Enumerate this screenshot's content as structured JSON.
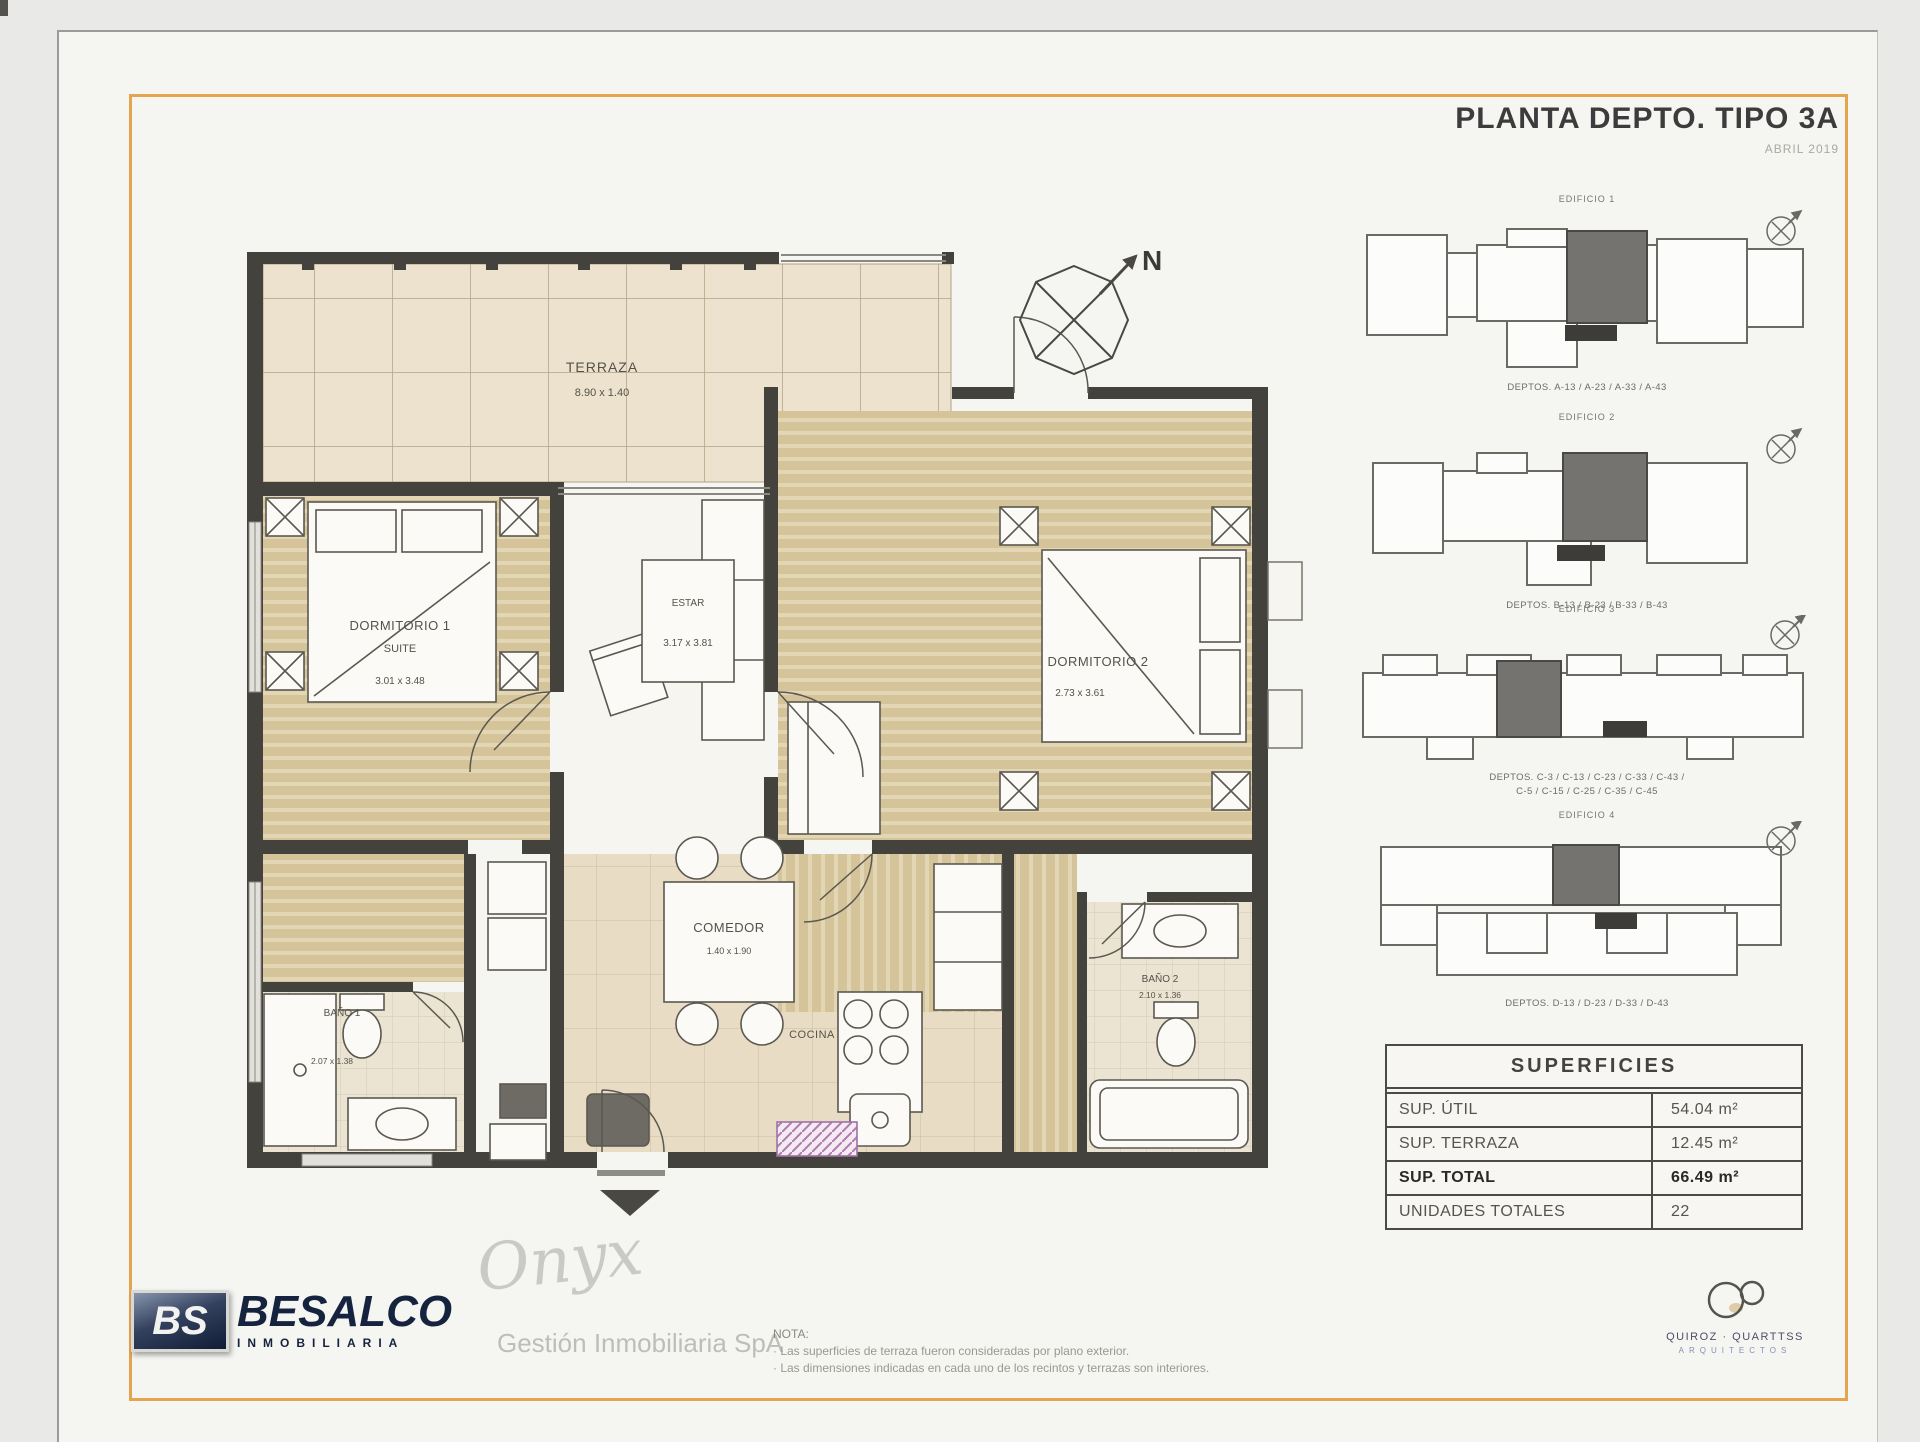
{
  "sheet": {
    "title": "PLANTA DEPTO. TIPO 3A",
    "subtitle": "ABRIL 2019"
  },
  "plan": {
    "compass_n": "N",
    "terraza": {
      "name": "TERRAZA",
      "dims": "8.90 x 1.40"
    },
    "dormitorio1": {
      "name": "DORMITORIO 1",
      "sub": "SUITE",
      "dims": "3.01 x 3.48"
    },
    "estar": {
      "name": "ESTAR",
      "dims": "3.17 x 3.81"
    },
    "dormitorio2": {
      "name": "DORMITORIO 2",
      "dims": "2.73 x 3.61"
    },
    "comedor": {
      "name": "COMEDOR",
      "dims": "1.40 x 1.90"
    },
    "cocina": {
      "name": "COCINA"
    },
    "bano1": {
      "name": "BAÑO 1",
      "dims": "2.07 x 1.38"
    },
    "bano2": {
      "name": "BAÑO 2",
      "dims": "2.10 x 1.36"
    }
  },
  "keyplans": [
    {
      "label": "EDIFICIO 1",
      "caption": "DEPTOS. A-13 / A-23 / A-33 / A-43"
    },
    {
      "label": "EDIFICIO 2",
      "caption": "DEPTOS. B-13 / B-23 / B-33 / B-43"
    },
    {
      "label": "EDIFICIO 3",
      "caption": "DEPTOS. C-3 / C-13 / C-23 / C-33 / C-43 /",
      "caption2": "C-5 / C-15 / C-25 / C-35 / C-45"
    },
    {
      "label": "EDIFICIO 4",
      "caption": "DEPTOS. D-13 / D-23 / D-33 / D-43"
    }
  ],
  "superficies": {
    "title": "SUPERFICIES",
    "rows": [
      {
        "label": "SUP. ÚTIL",
        "value": "54.04 m²"
      },
      {
        "label": "SUP. TERRAZA",
        "value": "12.45 m²"
      },
      {
        "label": "SUP. TOTAL",
        "value": "66.49 m²"
      },
      {
        "label": "UNIDADES TOTALES",
        "value": "22"
      }
    ]
  },
  "footer": {
    "logo_bs": "BS",
    "logo_name": "BESALCO",
    "logo_sub": "INMOBILIARIA",
    "watermark": "Onyx",
    "gestion": "Gestión Inmobiliaria SpA",
    "nota_title": "NOTA:",
    "nota_line1": "· Las superficies de terraza fueron consideradas por plano exterior.",
    "nota_line2": "· Las dimensiones indicadas en cada uno de los recintos y terrazas son interiores.",
    "arch_name": "QUIROZ · QUARTTSS",
    "arch_sub": "ARQUITECTOS"
  },
  "colors": {
    "frame_orange": "#e5a54e",
    "wall": "#44423c",
    "floor_beige": "#d5c49a",
    "brand_navy": "#16233f"
  }
}
